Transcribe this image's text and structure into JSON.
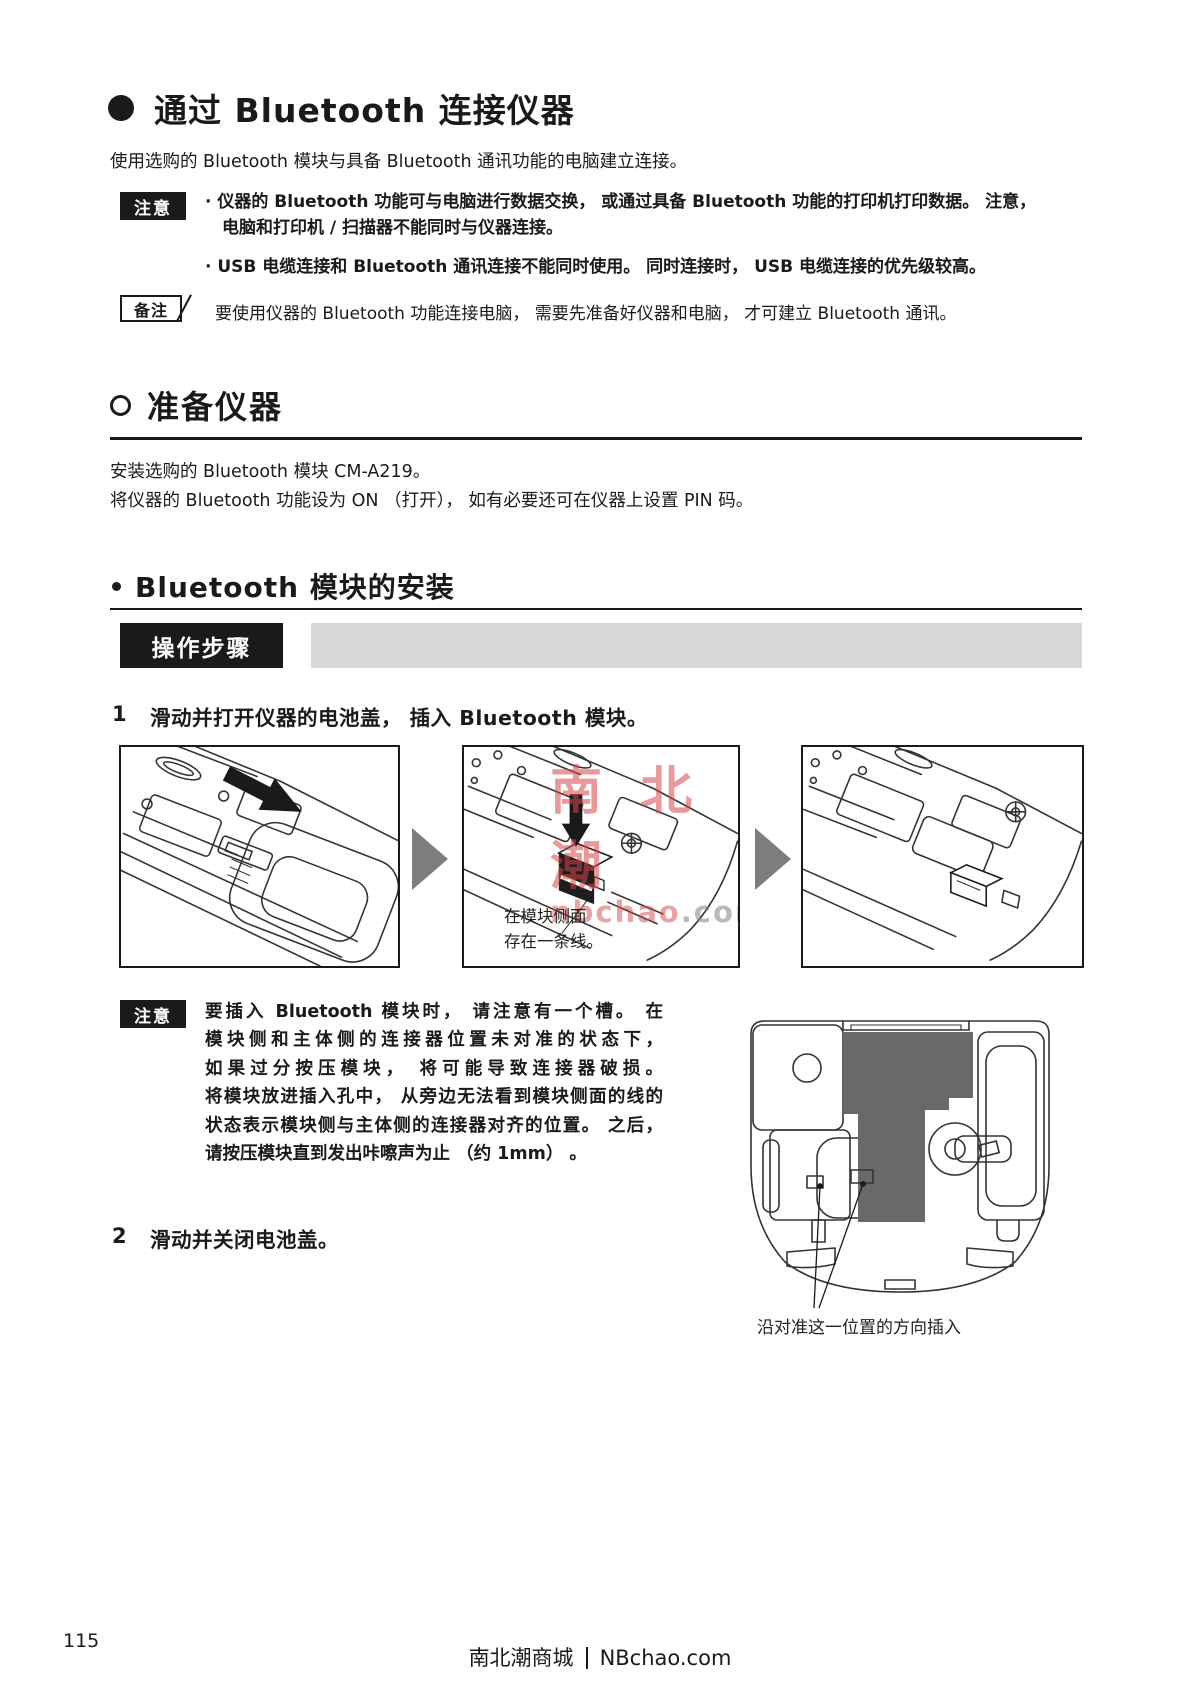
{
  "header": {
    "title": "通过 Bluetooth 连接仪器",
    "intro": "使用选购的 Bluetooth 模块与具备 Bluetooth 通讯功能的电脑建立连接。"
  },
  "caution_top": {
    "label": "注意",
    "bullet1_line1": "· 仪器的 Bluetooth 功能可与电脑进行数据交换， 或通过具备 Bluetooth 功能的打印机打印数据。 注意，",
    "bullet1_line2": "电脑和打印机 / 扫描器不能同时与仪器连接。",
    "bullet2": "· USB 电缆连接和 Bluetooth 通讯连接不能同时使用。 同时连接时， USB 电缆连接的优先级较高。"
  },
  "memo": {
    "label": "备注",
    "text": "要使用仪器的 Bluetooth 功能连接电脑， 需要先准备好仪器和电脑， 才可建立 Bluetooth 通讯。"
  },
  "section_prepare": {
    "title": "准备仪器",
    "line1": "安装选购的 Bluetooth 模块 CM-A219。",
    "line2": "将仪器的 Bluetooth 功能设为 ON （打开）， 如有必要还可在仪器上设置 PIN 码。"
  },
  "subsection_install": {
    "title": "Bluetooth 模块的安装",
    "procedure_label": "操作步骤"
  },
  "step1": {
    "number": "1",
    "text": "滑动并打开仪器的电池盖， 插入 Bluetooth 模块。",
    "panel2_caption_line1": "在模块侧面",
    "panel2_caption_line2": "存在一条线。"
  },
  "caution_step": {
    "label": "注意",
    "lines": [
      "要插入 Bluetooth 模块时， 请注意有一个槽。 在",
      "模块侧和主体侧的连接器位置未对准的状态下，",
      "如果过分按压模块， 将可能导致连接器破损。",
      "将模块放进插入孔中， 从旁边无法看到模块侧面的线的",
      "状态表示模块侧与主体侧的连接器对齐的位置。 之后，",
      "请按压模块直到发出咔嚓声为止 （约 1mm） 。"
    ]
  },
  "step2": {
    "number": "2",
    "text": "滑动并关闭电池盖。",
    "figure_caption": "沿对准这一位置的方向插入"
  },
  "watermark": {
    "line1": "南 北 潮",
    "line2_red": "nbchao",
    "line2_gray": ".com"
  },
  "footer": {
    "page_number": "115",
    "site_name": "南北潮商城",
    "site_url": "NBchao.com"
  },
  "colors": {
    "dark_fill": "#696969",
    "arrow_gray": "#7d7d7d",
    "bar_gray": "#d8d8d8"
  }
}
